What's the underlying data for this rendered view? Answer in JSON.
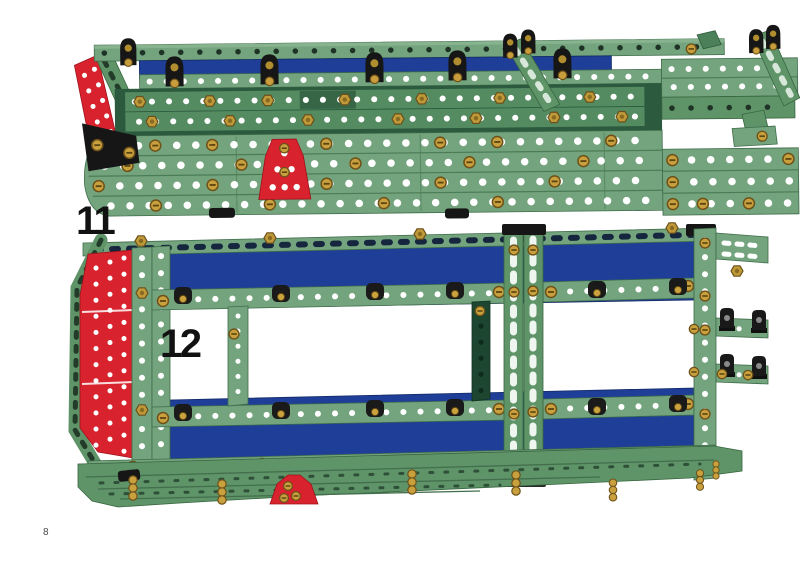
{
  "page": {
    "number": "8"
  },
  "steps": [
    {
      "label": "11"
    },
    {
      "label": "12"
    }
  ],
  "palette": {
    "strip_green_light": "#74a47e",
    "strip_green_mid": "#5f9469",
    "girder_green": "#558b61",
    "recess_green": "#2c5a3e",
    "plate_blue": "#1f3e98",
    "plate_red": "#d8232e",
    "brass_fastener": "#c9a03e",
    "fitting_black": "#161616",
    "background": "#ffffff",
    "label_color": "#111111"
  }
}
